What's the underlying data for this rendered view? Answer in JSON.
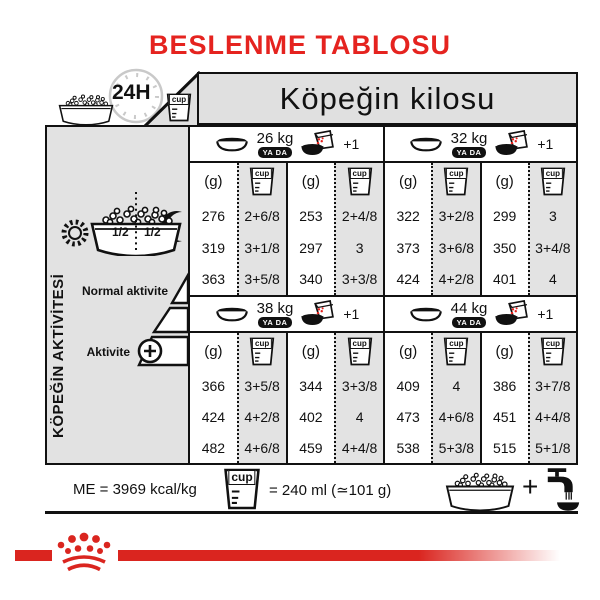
{
  "title": "BESLENME TABLOSU",
  "header": {
    "hours": "24H",
    "cup": "cup",
    "weight_title": "Köpeğin kilosu"
  },
  "sidebar": {
    "label": "KÖPEĞİN AKTİVİTESİ",
    "half_left": "1/2",
    "half_right": "1/2",
    "normal": "Normal aktivite",
    "active": "Aktivite"
  },
  "table": {
    "unit_g": "(g)",
    "unit_cup": "cup",
    "or": "YA DA",
    "plus_one": "+1"
  },
  "weights": [
    {
      "kg": "26 kg",
      "g1": [
        "276",
        "319",
        "363"
      ],
      "c1": [
        "2+6/8",
        "3+1/8",
        "3+5/8"
      ],
      "g2": [
        "253",
        "297",
        "340"
      ],
      "c2": [
        "2+4/8",
        "3",
        "3+3/8"
      ]
    },
    {
      "kg": "32 kg",
      "g1": [
        "322",
        "373",
        "424"
      ],
      "c1": [
        "3+2/8",
        "3+6/8",
        "4+2/8"
      ],
      "g2": [
        "299",
        "350",
        "401"
      ],
      "c2": [
        "3",
        "3+4/8",
        "4"
      ]
    },
    {
      "kg": "38 kg",
      "g1": [
        "366",
        "424",
        "482"
      ],
      "c1": [
        "3+5/8",
        "4+2/8",
        "4+6/8"
      ],
      "g2": [
        "344",
        "402",
        "459"
      ],
      "c2": [
        "3+3/8",
        "4",
        "4+4/8"
      ]
    },
    {
      "kg": "44 kg",
      "g1": [
        "409",
        "473",
        "538"
      ],
      "c1": [
        "4",
        "4+6/8",
        "5+3/8"
      ],
      "g2": [
        "386",
        "451",
        "515"
      ],
      "c2": [
        "3+7/8",
        "4+4/8",
        "5+1/8"
      ]
    }
  ],
  "footer": {
    "me": "ME = 3969 kcal/kg",
    "cup": "cup",
    "cup_equiv": "= 240 ml (≃101 g)",
    "plus": "+"
  },
  "colors": {
    "red": "#e5231f",
    "bar_red": "#da251f",
    "panel": "#e2e2e2",
    "line": "#111111"
  }
}
